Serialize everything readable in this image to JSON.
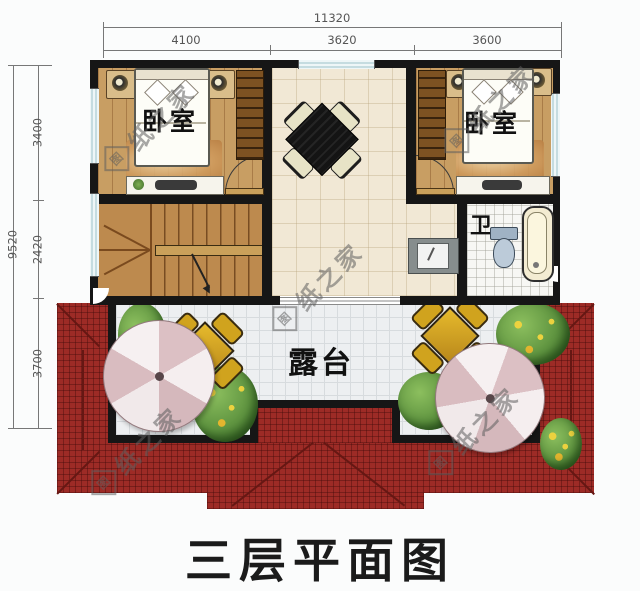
{
  "title": {
    "text": "三层平面图"
  },
  "watermark": {
    "seal_char": "图",
    "tail_text": "纸之家",
    "full_text": "图纸之家"
  },
  "dimensions": {
    "top": {
      "total": "11320",
      "segments": [
        "4100",
        "3620",
        "3600"
      ]
    },
    "left": {
      "total": "9520",
      "segments": [
        "3400",
        "2420",
        "3700"
      ]
    }
  },
  "rooms": {
    "bedroom_left": {
      "label": "卧室"
    },
    "bedroom_right": {
      "label": "卧室"
    },
    "bathroom": {
      "label": "卫"
    },
    "terrace": {
      "label": "露台"
    }
  },
  "colors": {
    "wall": "#161616",
    "roof_red": "#9d2b26",
    "wood_floor": "#c89e63",
    "tile_floor": "#f1e8d5",
    "terrace_tile": "#edeff1",
    "window_blue": "#9cc3c9",
    "table_black": "#161616",
    "terrace_table_gold": "#d6a21e",
    "umbrella_pink": "#dcc0c4",
    "plant_green": "#5f9440",
    "title_black": "#1b1b1b"
  }
}
